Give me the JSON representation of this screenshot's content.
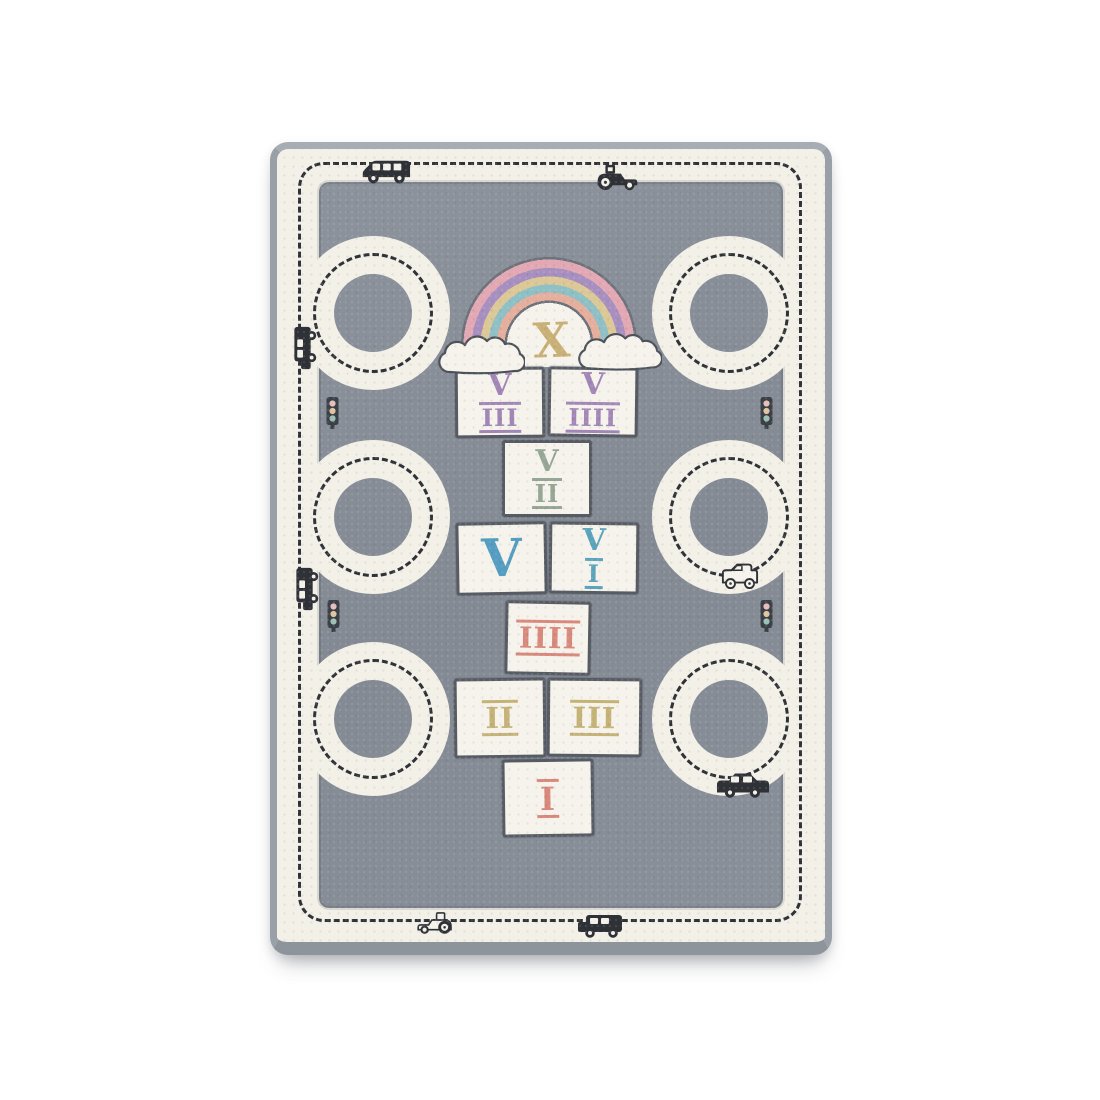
{
  "page": {
    "background": "#ffffff"
  },
  "rug": {
    "colors": {
      "field_gray": "#878d96",
      "road_cream": "#f3f0e8",
      "edge_gray": "#9da3ab",
      "square_outline": "#575c64",
      "dash_black": "#2f3237",
      "vehicle_black": "#2e3136"
    },
    "hopscotch": {
      "squares": [
        {
          "name": "ten",
          "top": "X",
          "bottom": "",
          "color": "#c9b077"
        },
        {
          "name": "eight",
          "top": "V",
          "bottom": "III",
          "color": "#a186b6"
        },
        {
          "name": "nine",
          "top": "V",
          "bottom": "IIII",
          "color": "#a186b6"
        },
        {
          "name": "seven",
          "top": "V",
          "bottom": "II",
          "color": "#97a795"
        },
        {
          "name": "five",
          "top": "V",
          "bottom": "",
          "color": "#559dc1"
        },
        {
          "name": "six",
          "top": "V",
          "bottom": "I",
          "color": "#5aa3bb"
        },
        {
          "name": "four",
          "top": "IIII",
          "bottom": "",
          "color": "#d8897c"
        },
        {
          "name": "two",
          "top": "II",
          "bottom": "",
          "color": "#c4b277"
        },
        {
          "name": "three",
          "top": "III",
          "bottom": "",
          "color": "#c4b277"
        },
        {
          "name": "one",
          "top": "I",
          "bottom": "",
          "color": "#d8897c"
        }
      ]
    },
    "rainbow": {
      "bands_outer_to_inner": [
        "#e2a8b3",
        "#a78fc0",
        "#dcc897",
        "#8fc0c5",
        "#e6ae9d"
      ]
    },
    "traffic_light": {
      "body": "#3b3f46",
      "lights": [
        "#e3bebc",
        "#dfc49e",
        "#9cc0b4"
      ],
      "count": 4
    },
    "loops": {
      "left": 3,
      "right": 3
    },
    "vehicles": [
      {
        "icon": "bus-icon",
        "area": "top-border-left"
      },
      {
        "icon": "tractor-icon",
        "area": "top-border-right"
      },
      {
        "icon": "truck-icon",
        "area": "left-border-upper"
      },
      {
        "icon": "truck-icon",
        "area": "left-border-middle"
      },
      {
        "icon": "jeep-icon",
        "area": "right-middle-loop"
      },
      {
        "icon": "car-icon",
        "area": "bottom-right-loop"
      },
      {
        "icon": "tractor-icon",
        "area": "bottom-border-left"
      },
      {
        "icon": "truck-icon",
        "area": "bottom-border-right"
      }
    ]
  }
}
